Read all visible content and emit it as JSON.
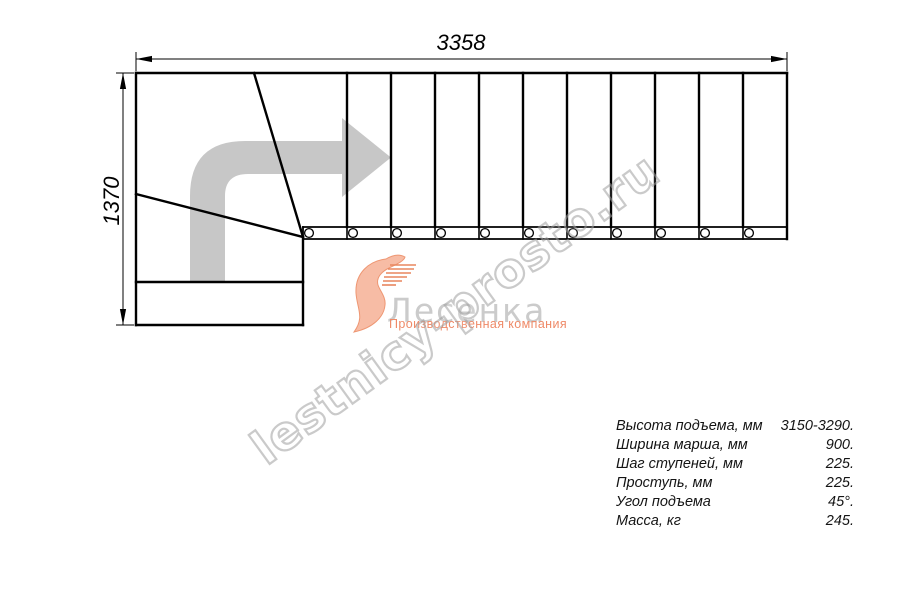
{
  "dimensions": {
    "width_top": "3358",
    "height_left": "1370"
  },
  "watermark": {
    "text": "lestnicy-prosto.ru"
  },
  "logo": {
    "name": "Лесенка",
    "tagline": "Производственная компания"
  },
  "specs": {
    "rows": [
      {
        "label": "Высота подъема, мм",
        "value": "3150-3290."
      },
      {
        "label": "Ширина марша, мм",
        "value": "900."
      },
      {
        "label": "Шаг ступеней, мм",
        "value": "225."
      },
      {
        "label": "Проступь, мм",
        "value": "225."
      },
      {
        "label": "Угол подъема",
        "value": "45°."
      },
      {
        "label": "Масса, кг",
        "value": "245."
      }
    ]
  },
  "colors": {
    "line": "#000000",
    "direction_arrow": "#c7c7c7",
    "logo_swoosh": "#f6b095",
    "logo_name": "#cbcbcb",
    "logo_tagline": "#ef8a68",
    "watermark_outline": "#9e9e9e",
    "background": "#ffffff"
  }
}
